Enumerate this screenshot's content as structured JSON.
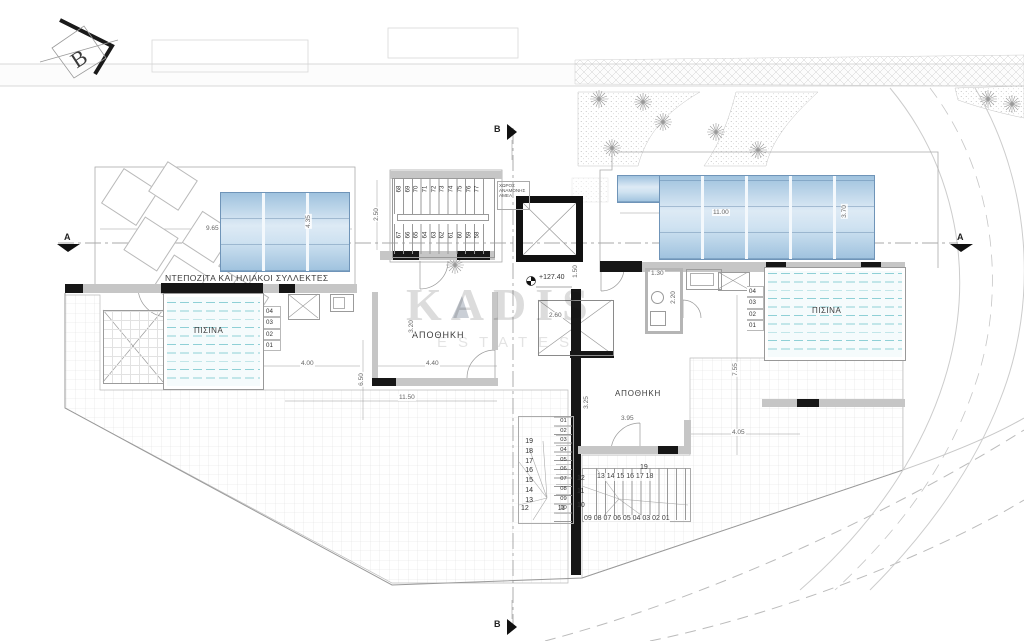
{
  "plan": {
    "watermark": {
      "brand": "KADIS",
      "sub": "ESTATES"
    },
    "north": "B",
    "sections": {
      "top": "B",
      "bottom": "B",
      "left": "A",
      "right": "A"
    },
    "level": "+127.40",
    "labels": {
      "solar": "ΝΤΕΠΟΖΙΤΑ ΚΑΙ ΗΛΙΑΚΟΙ ΣΥΛΛΕΚΤΕΣ",
      "pool_left": "ΠΙΣΙΝΑ",
      "pool_right": "ΠΙΣΙΝΑ",
      "storage_left": "ΑΠΟΘΗΚΗ",
      "storage_right": "ΑΠΟΘΗΚΗ",
      "amea": "ΧΩΡΟΣ ΑΝΑΜΟΝΗΣ ΑΜΕΑ"
    },
    "dims": {
      "solar_left_w": "9.65",
      "solar_left_h": "4.35",
      "stair_w": "2.50",
      "solar_right_w": "11.00",
      "solar_right_h": "3.70",
      "wc_w": "1.30",
      "elev_s": "1.50",
      "wc_h": "2.20",
      "sky": "2.60",
      "storage_left_w": "4.40",
      "storage_left_h": "3.20",
      "deck_left_w": "4.00",
      "deck_left_h": "6.50",
      "bottom_w": "11.50",
      "storage_right_w": "3.95",
      "storage_right_h": "3.25",
      "terrace_w": "4.05",
      "terrace_h": "7.55"
    },
    "stairs": {
      "upper_row": [
        "68",
        "69",
        "70",
        "71",
        "72",
        "73",
        "74",
        "75",
        "76",
        "77"
      ],
      "lower_row": [
        "67",
        "66",
        "65",
        "64",
        "63",
        "62",
        "61",
        "60",
        "59",
        "58"
      ],
      "pool_left_steps": [
        "04",
        "03",
        "02",
        "01"
      ],
      "pool_right_steps": [
        "04",
        "03",
        "02",
        "01"
      ],
      "sw_left": [
        "19",
        "18",
        "17",
        "16",
        "15",
        "14",
        "13"
      ],
      "sw_bottom": [
        "12",
        "11"
      ],
      "sw_right": [
        "01",
        "02",
        "03",
        "04",
        "05",
        "06",
        "07",
        "08",
        "09",
        "10"
      ],
      "se_left": [
        "12",
        "11",
        "10"
      ],
      "se_top": "13 14 15 16 17 18",
      "se_top_end": "19",
      "se_bottom": "09  08 07 06 05 04 03 02 01"
    }
  }
}
